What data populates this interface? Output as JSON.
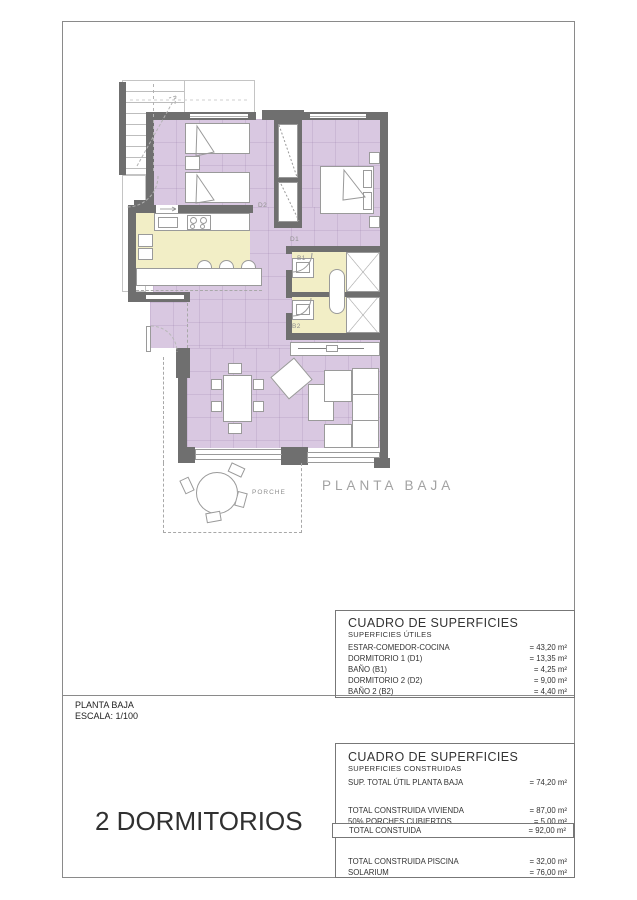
{
  "plan": {
    "caption": "PLANTA BAJA",
    "labels": {
      "d1": "D1",
      "d2": "D2",
      "b1": "B1",
      "b2": "B2",
      "porch": "PORCHE"
    }
  },
  "footer": {
    "title": "PLANTA BAJA",
    "scale": "ESCALA: 1/100",
    "headline": "2 DORMITORIOS"
  },
  "tables": {
    "utiles": {
      "title": "CUADRO DE SUPERFICIES",
      "subtitle": "SUPERFICIES ÚTILES",
      "rows": [
        {
          "label": "ESTAR-COMEDOR-COCINA",
          "value": "= 43,20 m²"
        },
        {
          "label": "DORMITORIO 1 (D1)",
          "value": "= 13,35 m²"
        },
        {
          "label": "BAÑO  (B1)",
          "value": "= 4,25 m²"
        },
        {
          "label": "DORMITORIO 2 (D2)",
          "value": "= 9,00 m²"
        },
        {
          "label": "BAÑO 2 (B2)",
          "value": "= 4,40 m²"
        }
      ]
    },
    "construidas": {
      "title": "CUADRO DE SUPERFICIES",
      "subtitle": "SUPERFICIES CONSTRUIDAS",
      "sup_total": {
        "label": "SUP. TOTAL ÚTIL PLANTA BAJA",
        "value": "= 74,20 m²"
      },
      "vivienda": {
        "label": "TOTAL CONSTRUIDA VIVIENDA",
        "value": "= 87,00 m²"
      },
      "porches": {
        "label": "50% PORCHES CUBIERTOS",
        "value": "= 5,00 m²"
      },
      "total_boxed": {
        "label": "TOTAL CONSTUIDA",
        "value": "= 92,00 m²"
      },
      "piscina": {
        "label": "TOTAL CONSTRUIDA PISCINA",
        "value": "= 32,00 m²"
      },
      "solarium": {
        "label": "SOLARIUM",
        "value": "= 76,00 m²"
      }
    }
  },
  "colors": {
    "purple": "#d9c8e1",
    "yellow": "#f2eec6",
    "wall": "#6f6f6f",
    "line": "#9a9a9a",
    "frame": "#8a8a8a",
    "caption": "#a2a2a2",
    "label": "#8f8f8f",
    "text": "#333333"
  }
}
